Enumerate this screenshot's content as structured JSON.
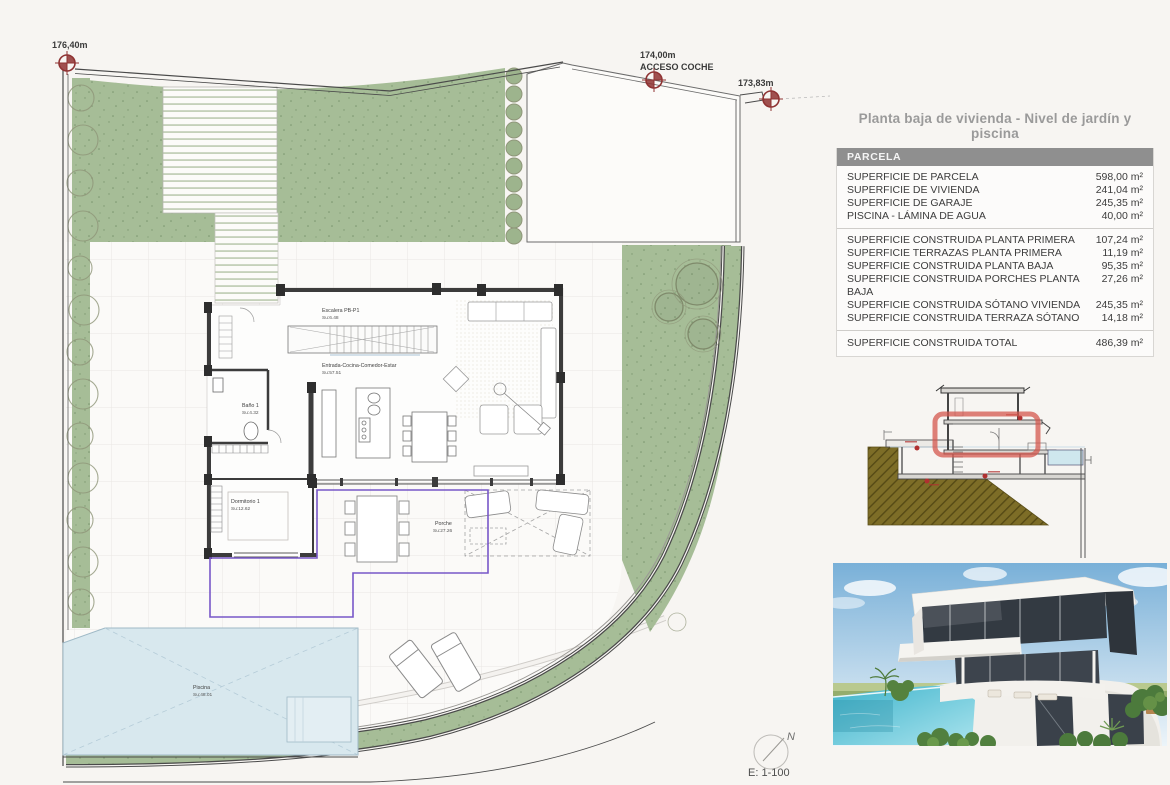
{
  "panel": {
    "title": "Planta baja de vivienda - Nivel de jardín y piscina",
    "table": {
      "header": "PARCELA",
      "groups": [
        {
          "rows": [
            {
              "label": "SUPERFICIE DE PARCELA",
              "value": "598,00 m²"
            },
            {
              "label": "SUPERFICIE DE VIVIENDA",
              "value": "241,04 m²"
            },
            {
              "label": "SUPERFICIE DE GARAJE",
              "value": "245,35 m²"
            },
            {
              "label": "PISCINA - LÁMINA DE AGUA",
              "value": "40,00 m²"
            }
          ]
        },
        {
          "rows": [
            {
              "label": "SUPERFICIE CONSTRUIDA PLANTA PRIMERA",
              "value": "107,24 m²"
            },
            {
              "label": "SUPERFICIE TERRAZAS PLANTA PRIMERA",
              "value": "11,19 m²"
            },
            {
              "label": "SUPERFICIE CONSTRUIDA PLANTA BAJA",
              "value": "95,35 m²"
            },
            {
              "label": "SUPERFICIE CONSTRUIDA PORCHES PLANTA BAJA",
              "value": "27,26 m²"
            },
            {
              "label": "SUPERFICIE CONSTRUIDA SÓTANO VIVIENDA",
              "value": "245,35 m²"
            },
            {
              "label": "SUPERFICIE CONSTRUIDA TERRAZA SÓTANO",
              "value": "14,18 m²"
            }
          ]
        }
      ],
      "total": {
        "label": "SUPERFICIE CONSTRUIDA TOTAL",
        "value": "486,39 m²"
      }
    }
  },
  "plan": {
    "markers": [
      {
        "label": "176,40m"
      },
      {
        "label": "174,00m",
        "sublabel": "ACCESO COCHE"
      },
      {
        "label": "173,83m"
      }
    ],
    "rooms": {
      "escalera": {
        "name": "Escalera PB-P1",
        "area": "Su:6.48"
      },
      "entrada": {
        "name": "Entrada-Cocina-Comedor-Estar",
        "area": "Su:57.51"
      },
      "bano": {
        "name": "Baño 1",
        "area": "Su:4.32"
      },
      "dormitorio": {
        "name": "Dormitorio 1",
        "area": "Su:12.62"
      },
      "porche": {
        "name": "Porche",
        "area": "Su:27.26"
      },
      "piscina": {
        "name": "Piscina",
        "area": "Su:48.01"
      }
    },
    "scale_label": "E: 1-100",
    "north_label": "N"
  },
  "colors": {
    "garden_green": "#a6bd97",
    "pool_blue": "#d8e8ee",
    "wall_dark": "#3c3c3c",
    "overhang_purple": "#7857c8",
    "marker_red": "#8f3333",
    "section_earth": "#7d6d27",
    "section_highlight": "#d4574e",
    "table_header_gray": "#8f8f8f"
  }
}
